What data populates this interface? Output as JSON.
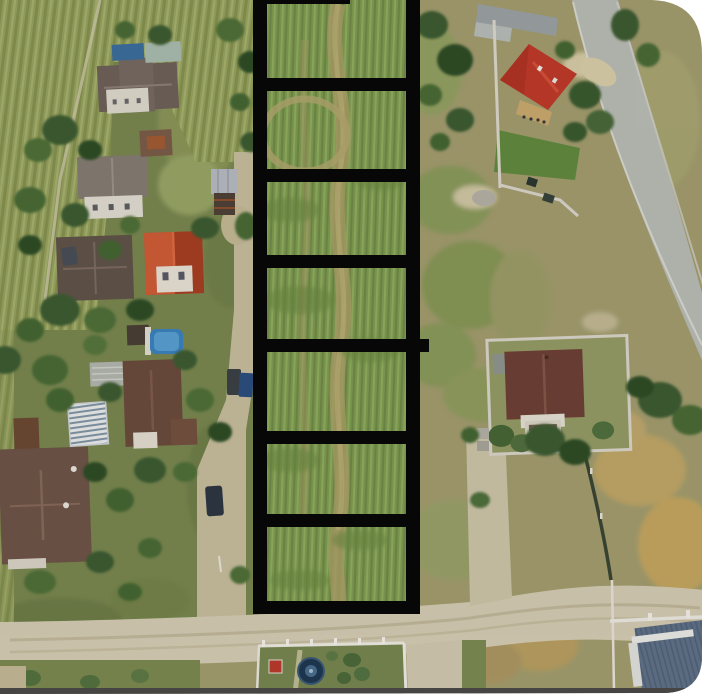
{
  "photo": {
    "border_color": "#ffffff",
    "bottom_edge_color": "#474544",
    "corner_radius_top_right": 52,
    "corner_radius_bottom_right": 34
  },
  "overlay": {
    "color": "#070707",
    "strip": {
      "x": 253,
      "width": 167,
      "top": 0,
      "bottom": 614
    },
    "bar_width": 14,
    "rung_height": 13,
    "rungs_y": [
      78,
      169,
      255,
      339,
      431,
      514,
      601
    ],
    "top_rung": {
      "x": 253,
      "y": 0,
      "width": 97,
      "height": 4
    },
    "nub": {
      "x": 418,
      "y": 339,
      "width": 11,
      "height": 13
    },
    "parcel_count": 7
  },
  "palette": {
    "field_olive": "#96a161",
    "parcel_grass": "#7e9b50",
    "dirt_road": "#d3cbb2",
    "asphalt_road": "#b9bcb4",
    "red_roof": "#bf3a2a",
    "orange_roof": "#c14f2e",
    "brown_roof": "#6b4c3e",
    "slate_roof": "#5f7086",
    "pool_blue": "#3b83bd",
    "tree_green": "#3c5c30"
  }
}
